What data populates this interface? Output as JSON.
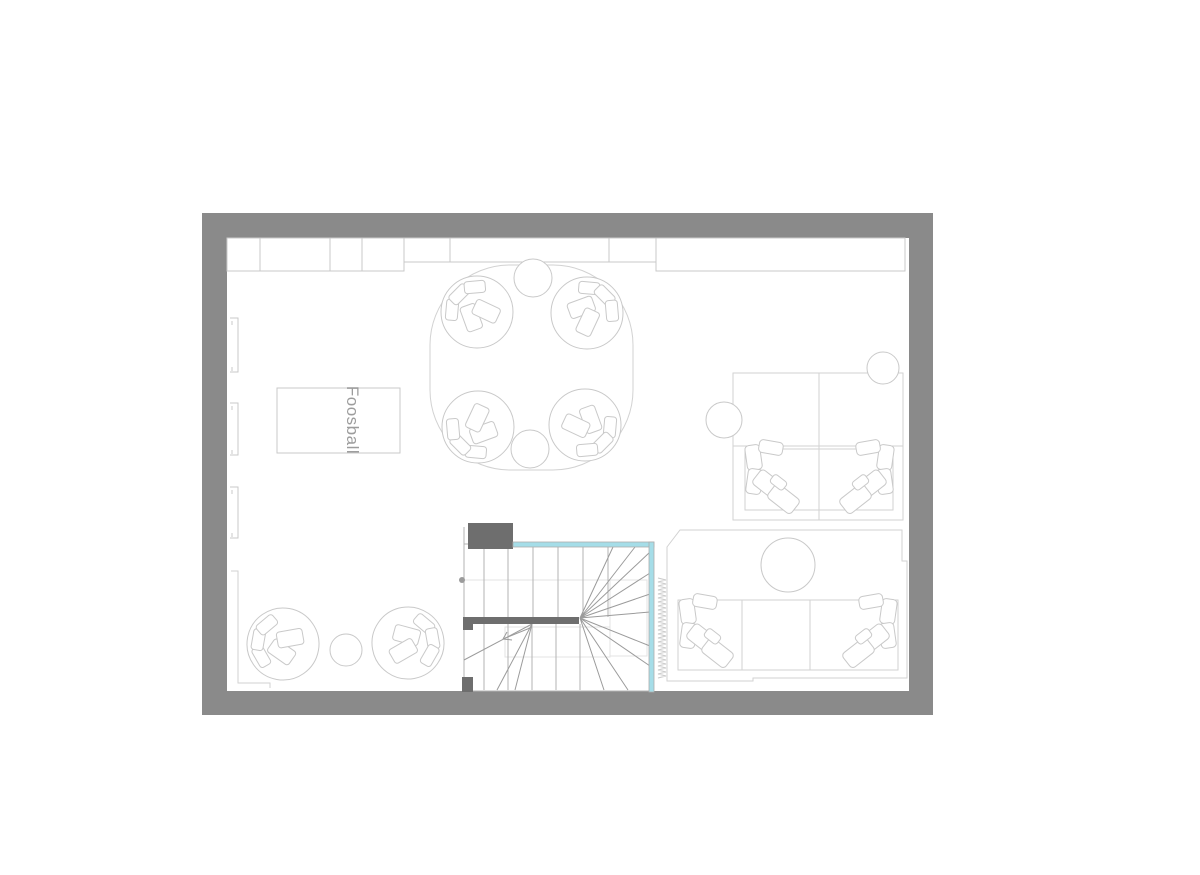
{
  "plan": {
    "foosball_label": "Foosball",
    "colors": {
      "page_bg": "#ffffff",
      "wall": "#8a8a8a",
      "wall_dark": "#6e6e6e",
      "line": "#c9c9c9",
      "line_soft": "#d2d2d2",
      "stair": "#b3b3b3",
      "diag": "#9b9b9b",
      "faint": "#e3e3e3",
      "glass": "#a5dde8",
      "label": "#9c9c9c"
    },
    "legend": [
      "exterior-wall",
      "kitchen-cabinets",
      "window",
      "foosball-table",
      "round-lounge-group",
      "tub-chair",
      "stool",
      "side-table",
      "area-rug",
      "lounge-chair",
      "coffee-table",
      "planter",
      "staircase",
      "glass-balustrade",
      "landing-wall",
      "curtain"
    ]
  }
}
